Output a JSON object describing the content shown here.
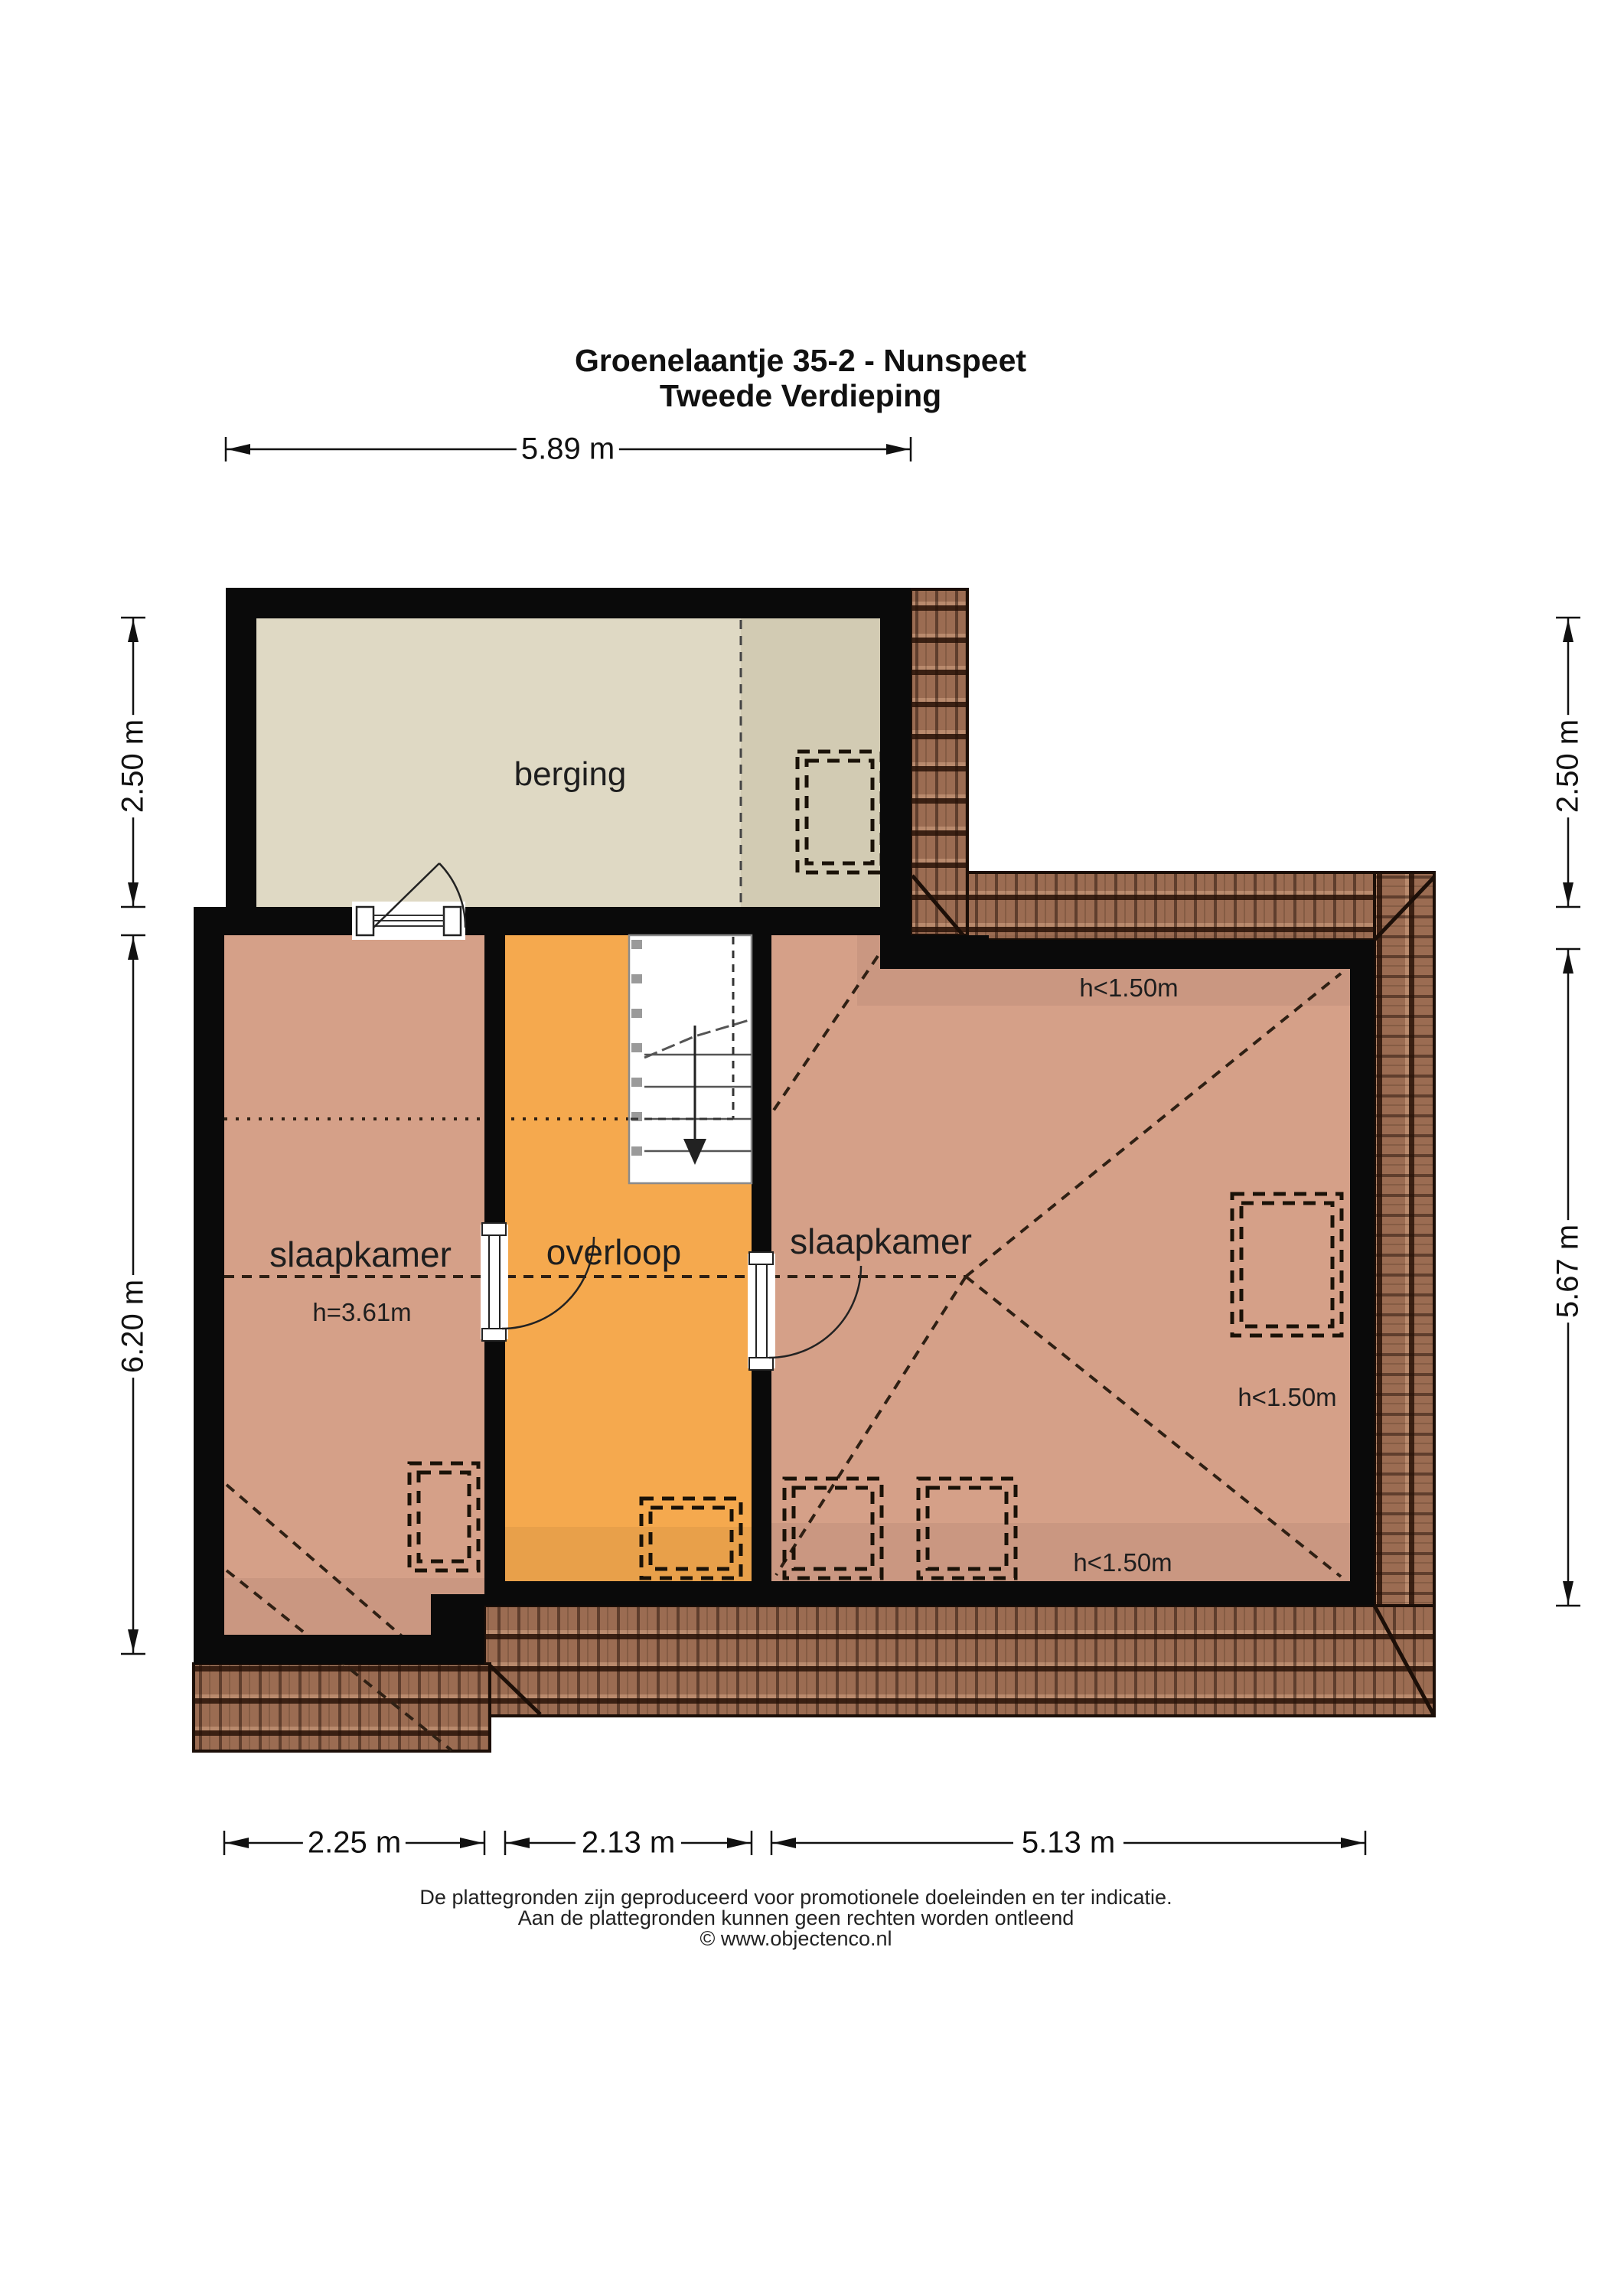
{
  "title": {
    "line1": "Groenelaantje 35-2 - Nunspeet",
    "line2": "Tweede Verdieping"
  },
  "dimensions": {
    "top": "5.89 m",
    "left_upper": "2.50 m",
    "left_lower": "6.20 m",
    "right_upper": "2.50 m",
    "right_lower": "5.67 m",
    "bottom_left": "2.25 m",
    "bottom_middle": "2.13 m",
    "bottom_right": "5.13 m"
  },
  "rooms": {
    "storage": "berging",
    "bedroom_left": "slaapkamer",
    "landing": "overloop",
    "bedroom_right": "slaapkamer"
  },
  "height_labels": {
    "bedroom_left_height": "h=3.61m",
    "attic_top": "h<1.50m",
    "attic_right": "h<1.50m",
    "attic_bottom": "h<1.50m"
  },
  "footer": {
    "line1": "De plattegronden zijn geproduceerd voor promotionele doeleinden en ter indicatie.",
    "line2": "Aan de plattegronden kunnen geen rechten worden ontleend",
    "line3": "© www.objectenco.nl"
  },
  "colors": {
    "wall": "#0a0a0a",
    "storage_floor": "#dfd9c4",
    "bedroom_floor": "#d5a088",
    "landing_floor": "#f5a94e",
    "roof_tile_base": "#9b6c52",
    "roof_tile_dark": "#3a2013"
  }
}
